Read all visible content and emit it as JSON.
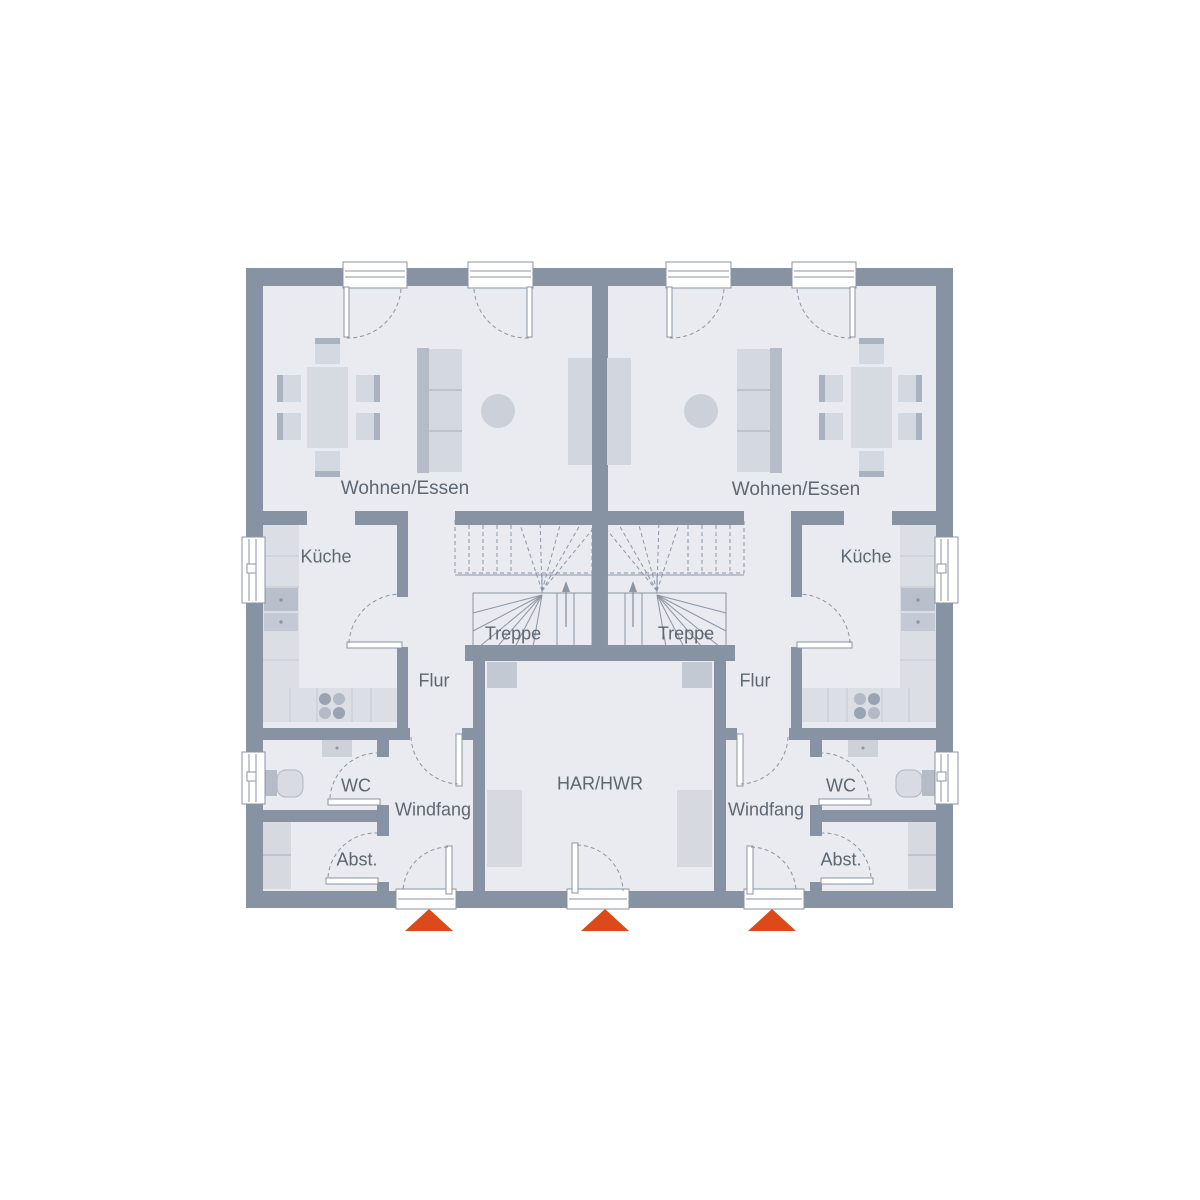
{
  "rooms": {
    "wohnen_essen_left": "Wohnen/Essen",
    "wohnen_essen_right": "Wohnen/Essen",
    "kueche_left": "Küche",
    "kueche_right": "Küche",
    "treppe_left": "Treppe",
    "treppe_right": "Treppe",
    "flur_left": "Flur",
    "flur_right": "Flur",
    "wc_left": "WC",
    "wc_right": "WC",
    "windfang_left": "Windfang",
    "windfang_right": "Windfang",
    "abst_left": "Abst.",
    "abst_right": "Abst.",
    "har_hwr": "HAR/HWR"
  },
  "colors": {
    "wall": "#8792a2",
    "floor": "#e9ebf0",
    "furniture_light": "#d4d8e0",
    "furniture_mid": "#c3c9d3",
    "furniture_dark": "#aab2bf",
    "line": "#8b95a4",
    "label_text": "#5e6772",
    "entrance_marker": "#dd4a1a",
    "background": "#ffffff"
  },
  "markers": {
    "entrance_marker_icon": "triangle-up",
    "entrance_marker_count": 3
  },
  "stairs": {
    "direction_icon": "arrow-up",
    "flights": 2
  }
}
